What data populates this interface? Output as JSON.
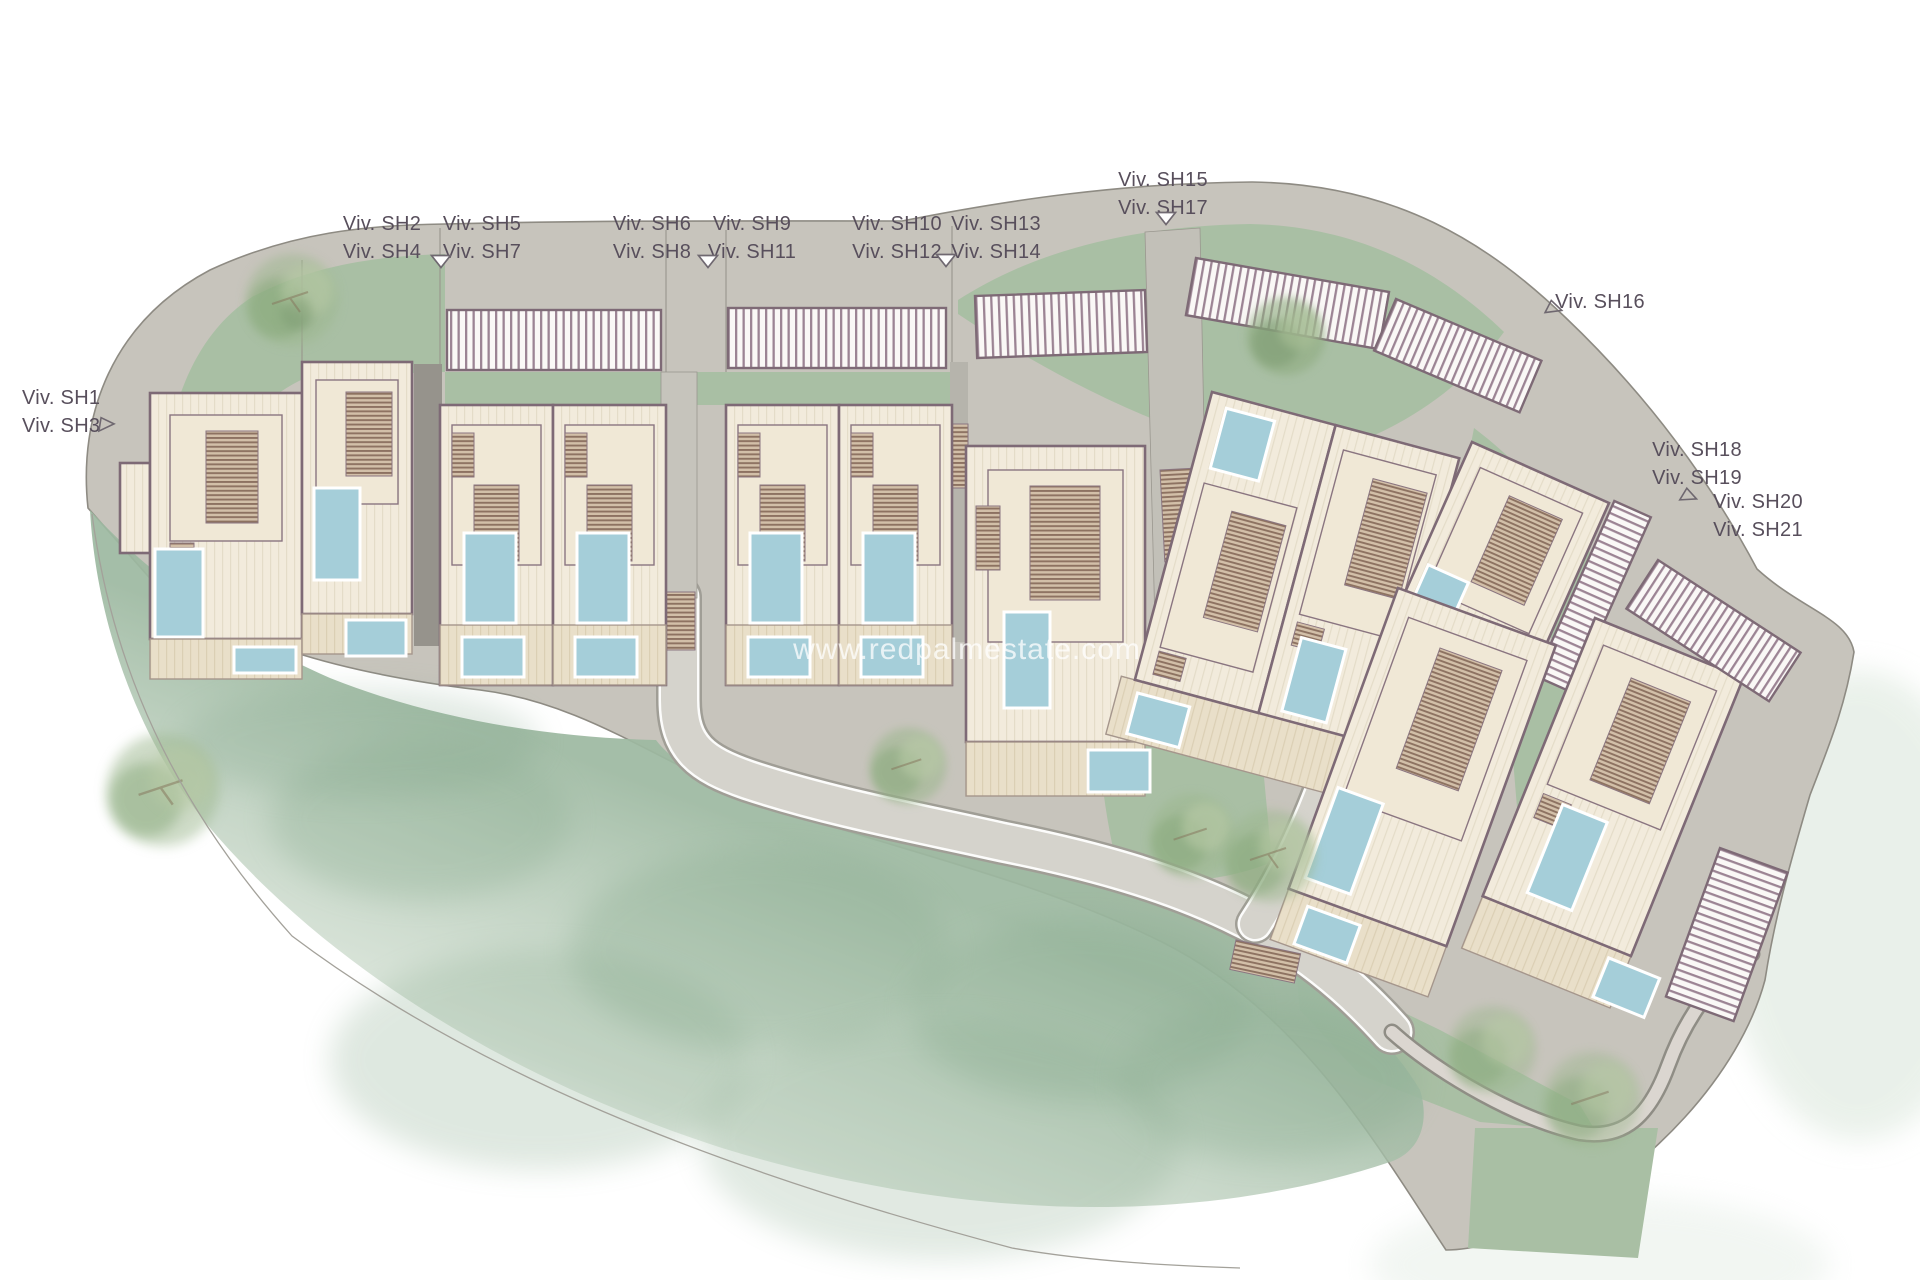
{
  "plan": {
    "kind": "residential development site plan",
    "watermark": "www.redpalmestate.com"
  },
  "labels": [
    {
      "id": "viv-sh1-sh3",
      "lines": [
        "Viv. SH1",
        "Viv. SH3"
      ]
    },
    {
      "id": "viv-sh2-sh4",
      "lines": [
        "Viv. SH2",
        "Viv. SH4"
      ]
    },
    {
      "id": "viv-sh5-sh7",
      "lines": [
        "Viv. SH5",
        "Viv. SH7"
      ]
    },
    {
      "id": "viv-sh6-sh8",
      "lines": [
        "Viv. SH6",
        "Viv. SH8"
      ]
    },
    {
      "id": "viv-sh9-sh11",
      "lines": [
        "Viv. SH9",
        "Viv. SH11"
      ]
    },
    {
      "id": "viv-sh10-sh12",
      "lines": [
        "Viv. SH10",
        "Viv. SH12"
      ]
    },
    {
      "id": "viv-sh13-sh14",
      "lines": [
        "Viv. SH13",
        "Viv. SH14"
      ]
    },
    {
      "id": "viv-sh15-sh17",
      "lines": [
        "Viv. SH15",
        "Viv. SH17"
      ]
    },
    {
      "id": "viv-sh16",
      "lines": [
        "Viv. SH16"
      ]
    },
    {
      "id": "viv-sh18-sh19",
      "lines": [
        "Viv. SH18",
        "Viv. SH19"
      ]
    },
    {
      "id": "viv-sh20-sh21",
      "lines": [
        "Viv. SH20",
        "Viv. SH21"
      ]
    }
  ],
  "markers": {
    "pointer_filled": "triangle-down-icon",
    "pointer_open": "triangle-outline-icon"
  },
  "palette": {
    "pavement": "#c7c4bc",
    "road_fill": "#d5d3cc",
    "lawn": "#a9bfa4",
    "watercolor_lawn": "#9cb8a0",
    "building_fill": "#f2ebdc",
    "building_outline": "#7e6a76",
    "pergola_stripe": "#9c8494",
    "pool": "#a5ced9",
    "terrace": "#e9dfc9",
    "label_text": "#584f5c",
    "watermark_text": "#ffffff"
  }
}
